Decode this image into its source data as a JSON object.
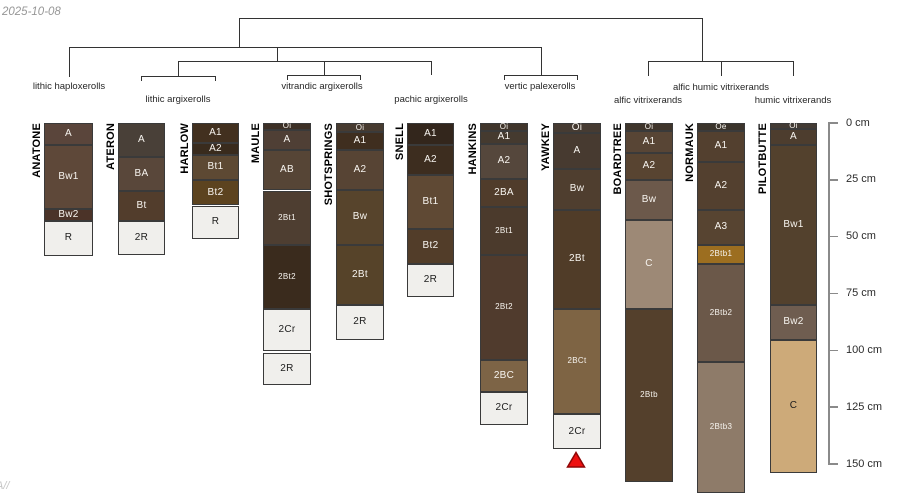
{
  "figure": {
    "date": "2025-10-08",
    "watermark": "A//",
    "background": "#ffffff"
  },
  "dendrogram": {
    "line_color": "#333333",
    "segments": [
      {
        "x1": 239,
        "y1": 18,
        "x2": 702,
        "y2": 18
      },
      {
        "x1": 239,
        "y1": 18,
        "x2": 239,
        "y2": 47
      },
      {
        "x1": 69,
        "y1": 47,
        "x2": 541,
        "y2": 47
      },
      {
        "x1": 69,
        "y1": 47,
        "x2": 69,
        "y2": 77
      },
      {
        "x1": 277,
        "y1": 47,
        "x2": 277,
        "y2": 61
      },
      {
        "x1": 178,
        "y1": 61,
        "x2": 431,
        "y2": 61
      },
      {
        "x1": 178,
        "y1": 61,
        "x2": 178,
        "y2": 76
      },
      {
        "x1": 141,
        "y1": 76,
        "x2": 215,
        "y2": 76
      },
      {
        "x1": 141,
        "y1": 76,
        "x2": 141,
        "y2": 81
      },
      {
        "x1": 215,
        "y1": 76,
        "x2": 215,
        "y2": 81
      },
      {
        "x1": 324,
        "y1": 61,
        "x2": 324,
        "y2": 75
      },
      {
        "x1": 287,
        "y1": 75,
        "x2": 360,
        "y2": 75
      },
      {
        "x1": 287,
        "y1": 75,
        "x2": 287,
        "y2": 80
      },
      {
        "x1": 360,
        "y1": 75,
        "x2": 360,
        "y2": 80
      },
      {
        "x1": 431,
        "y1": 61,
        "x2": 431,
        "y2": 75
      },
      {
        "x1": 541,
        "y1": 47,
        "x2": 541,
        "y2": 75
      },
      {
        "x1": 504,
        "y1": 75,
        "x2": 577,
        "y2": 75
      },
      {
        "x1": 504,
        "y1": 75,
        "x2": 504,
        "y2": 80
      },
      {
        "x1": 577,
        "y1": 75,
        "x2": 577,
        "y2": 80
      },
      {
        "x1": 702,
        "y1": 18,
        "x2": 702,
        "y2": 61
      },
      {
        "x1": 648,
        "y1": 61,
        "x2": 793,
        "y2": 61
      },
      {
        "x1": 648,
        "y1": 61,
        "x2": 648,
        "y2": 76
      },
      {
        "x1": 721,
        "y1": 61,
        "x2": 721,
        "y2": 76
      },
      {
        "x1": 793,
        "y1": 61,
        "x2": 793,
        "y2": 76
      }
    ],
    "taxa": [
      {
        "label": "lithic haploxerolls",
        "x": 69,
        "y": 87
      },
      {
        "label": "lithic argixerolls",
        "x": 178,
        "y": 100
      },
      {
        "label": "vitrandic argixerolls",
        "x": 322,
        "y": 87
      },
      {
        "label": "pachic argixerolls",
        "x": 431,
        "y": 100
      },
      {
        "label": "vertic palexerolls",
        "x": 540,
        "y": 87
      },
      {
        "label": "alfic humic vitrixerands",
        "x": 721,
        "y": 88
      },
      {
        "label": "alfic vitrixerands",
        "x": 648,
        "y": 101
      },
      {
        "label": "humic vitrixerands",
        "x": 793,
        "y": 101
      }
    ]
  },
  "depth_axis": {
    "unit": "cm",
    "line_color": "#8a8a8a",
    "label_color": "#2b2b2b",
    "ticks": [
      {
        "cm": 0,
        "label": "0 cm"
      },
      {
        "cm": 25,
        "label": "25 cm"
      },
      {
        "cm": 50,
        "label": "50 cm"
      },
      {
        "cm": 75,
        "label": "75 cm"
      },
      {
        "cm": 100,
        "label": "100 cm"
      },
      {
        "cm": 125,
        "label": "125 cm"
      },
      {
        "cm": 150,
        "label": "150 cm"
      }
    ]
  },
  "profiles": [
    {
      "name": "ANATONE",
      "x": 44,
      "width": 49,
      "horizons": [
        {
          "name": "A",
          "top_cm": 0,
          "bottom_cm": 9.5,
          "color": "#5a453b"
        },
        {
          "name": "Bw1",
          "top_cm": 9.5,
          "bottom_cm": 38,
          "color": "#5e4839"
        },
        {
          "name": "Bw2",
          "top_cm": 38,
          "bottom_cm": 43,
          "color": "#4b3328"
        },
        {
          "name": "R",
          "top_cm": 43,
          "bottom_cm": 58.5,
          "color": "#f0efec"
        }
      ]
    },
    {
      "name": "ATERON",
      "x": 118,
      "width": 47,
      "horizons": [
        {
          "name": "A",
          "top_cm": 0,
          "bottom_cm": 15,
          "color": "#494038"
        },
        {
          "name": "BA",
          "top_cm": 15,
          "bottom_cm": 30,
          "color": "#59473a"
        },
        {
          "name": "Bt",
          "top_cm": 30,
          "bottom_cm": 43,
          "color": "#523d2c"
        },
        {
          "name": "2R",
          "top_cm": 43,
          "bottom_cm": 58,
          "color": "#f0efec"
        }
      ]
    },
    {
      "name": "HARLOW",
      "x": 192,
      "width": 47,
      "horizons": [
        {
          "name": "A1",
          "top_cm": 0,
          "bottom_cm": 8.8,
          "color": "#42301f"
        },
        {
          "name": "A2",
          "top_cm": 8.8,
          "bottom_cm": 14,
          "color": "#392b1d"
        },
        {
          "name": "Bt1",
          "top_cm": 14,
          "bottom_cm": 25,
          "color": "#5d4933"
        },
        {
          "name": "Bt2",
          "top_cm": 25,
          "bottom_cm": 36.3,
          "color": "#5c431f"
        },
        {
          "name": "R",
          "top_cm": 36.3,
          "bottom_cm": 51,
          "color": "#f0efec"
        }
      ]
    },
    {
      "name": "MAULE",
      "x": 263,
      "width": 48,
      "horizons": [
        {
          "name": "Oi",
          "top_cm": 0,
          "bottom_cm": 3,
          "color": "#3d3026"
        },
        {
          "name": "A",
          "top_cm": 3,
          "bottom_cm": 12,
          "color": "#4f3f35"
        },
        {
          "name": "AB",
          "top_cm": 12,
          "bottom_cm": 29.7,
          "color": "#564536"
        },
        {
          "name": "2Bt1",
          "top_cm": 29.7,
          "bottom_cm": 53.5,
          "color": "#4e3e31"
        },
        {
          "name": "2Bt2",
          "top_cm": 53.5,
          "bottom_cm": 81.7,
          "color": "#3a2b1d"
        },
        {
          "name": "2Cr",
          "top_cm": 81.7,
          "bottom_cm": 100.2,
          "color": "#f0efec"
        },
        {
          "name": "2R",
          "top_cm": 101.2,
          "bottom_cm": 115.3,
          "color": "#f0efec"
        }
      ]
    },
    {
      "name": "SHOTSPRINGS",
      "x": 336,
      "width": 48,
      "horizons": [
        {
          "name": "Oi",
          "top_cm": 0,
          "bottom_cm": 4,
          "color": "#473b30"
        },
        {
          "name": "A1",
          "top_cm": 4,
          "bottom_cm": 11.7,
          "color": "#3f2e1f"
        },
        {
          "name": "A2",
          "top_cm": 11.7,
          "bottom_cm": 29.3,
          "color": "#574434"
        },
        {
          "name": "Bw",
          "top_cm": 29.3,
          "bottom_cm": 53.5,
          "color": "#57442c"
        },
        {
          "name": "2Bt",
          "top_cm": 53.5,
          "bottom_cm": 80,
          "color": "#564329"
        },
        {
          "name": "2R",
          "top_cm": 80,
          "bottom_cm": 95.4,
          "color": "#f0efec"
        }
      ]
    },
    {
      "name": "SNELL",
      "x": 407,
      "width": 47,
      "horizons": [
        {
          "name": "A1",
          "top_cm": 0,
          "bottom_cm": 9.5,
          "color": "#33261c"
        },
        {
          "name": "A2",
          "top_cm": 9.5,
          "bottom_cm": 22.7,
          "color": "#3d2d1f"
        },
        {
          "name": "Bt1",
          "top_cm": 22.7,
          "bottom_cm": 46.5,
          "color": "#5f4934"
        },
        {
          "name": "Bt2",
          "top_cm": 46.5,
          "bottom_cm": 61.9,
          "color": "#523d29"
        },
        {
          "name": "2R",
          "top_cm": 61.9,
          "bottom_cm": 76.4,
          "color": "#f0efec"
        }
      ]
    },
    {
      "name": "HANKINS",
      "x": 480,
      "width": 48,
      "horizons": [
        {
          "name": "Oi",
          "top_cm": 0,
          "bottom_cm": 3.3,
          "color": "#40352b"
        },
        {
          "name": "A1",
          "top_cm": 3.3,
          "bottom_cm": 9,
          "color": "#453a2f"
        },
        {
          "name": "A2",
          "top_cm": 9,
          "bottom_cm": 24.4,
          "color": "#55473c"
        },
        {
          "name": "2BA",
          "top_cm": 24.4,
          "bottom_cm": 36.8,
          "color": "#503c2b"
        },
        {
          "name": "2Bt1",
          "top_cm": 36.8,
          "bottom_cm": 57.9,
          "color": "#4b3a2c"
        },
        {
          "name": "2Bt2",
          "top_cm": 57.9,
          "bottom_cm": 104.2,
          "color": "#503b2d"
        },
        {
          "name": "2BC",
          "top_cm": 104.2,
          "bottom_cm": 118.3,
          "color": "#7d6446"
        },
        {
          "name": "2Cr",
          "top_cm": 118.3,
          "bottom_cm": 132.8,
          "color": "#f0efec"
        }
      ]
    },
    {
      "name": "YAWKEY",
      "x": 553,
      "width": 48,
      "horizons": [
        {
          "name": "Oi",
          "top_cm": 0,
          "bottom_cm": 4.4,
          "color": "#463b32"
        },
        {
          "name": "A",
          "top_cm": 4.4,
          "bottom_cm": 20,
          "color": "#473a30"
        },
        {
          "name": "Bw",
          "top_cm": 20,
          "bottom_cm": 38.1,
          "color": "#4f3e2f"
        },
        {
          "name": "2Bt",
          "top_cm": 38.1,
          "bottom_cm": 81.7,
          "color": "#503c28"
        },
        {
          "name": "2BCt",
          "top_cm": 81.7,
          "bottom_cm": 128,
          "color": "#7e6444"
        },
        {
          "name": "2Cr",
          "top_cm": 128,
          "bottom_cm": 143.4,
          "color": "#f0efec"
        }
      ]
    },
    {
      "name": "BOARDTREE",
      "x": 625,
      "width": 48,
      "horizons": [
        {
          "name": "Oi",
          "top_cm": 0,
          "bottom_cm": 3.5,
          "color": "#3f352b"
        },
        {
          "name": "A1",
          "top_cm": 3.5,
          "bottom_cm": 13,
          "color": "#584535"
        },
        {
          "name": "A2",
          "top_cm": 13,
          "bottom_cm": 24.9,
          "color": "#584431"
        },
        {
          "name": "Bw",
          "top_cm": 24.9,
          "bottom_cm": 42.5,
          "color": "#6c594b"
        },
        {
          "name": "C",
          "top_cm": 42.5,
          "bottom_cm": 81.7,
          "color": "#9d8976"
        },
        {
          "name": "2Btb",
          "top_cm": 81.7,
          "bottom_cm": 157.9,
          "color": "#54402c"
        }
      ]
    },
    {
      "name": "NORMAUK",
      "x": 697,
      "width": 48,
      "horizons": [
        {
          "name": "Oe",
          "top_cm": 0,
          "bottom_cm": 3.7,
          "color": "#3b342c"
        },
        {
          "name": "A1",
          "top_cm": 3.7,
          "bottom_cm": 17,
          "color": "#53402f"
        },
        {
          "name": "A2",
          "top_cm": 17,
          "bottom_cm": 38.1,
          "color": "#53402f"
        },
        {
          "name": "A3",
          "top_cm": 38.1,
          "bottom_cm": 53.5,
          "color": "#574431"
        },
        {
          "name": "2Btb1",
          "top_cm": 53.5,
          "bottom_cm": 61.9,
          "color": "#9c6e20"
        },
        {
          "name": "2Btb2",
          "top_cm": 61.9,
          "bottom_cm": 105.1,
          "color": "#6b5849"
        },
        {
          "name": "2Btb3",
          "top_cm": 105.1,
          "bottom_cm": 162.8,
          "color": "#8e7b69"
        }
      ]
    },
    {
      "name": "PILOTBUTTE",
      "x": 770,
      "width": 47,
      "horizons": [
        {
          "name": "Oi",
          "top_cm": 0,
          "bottom_cm": 2.6,
          "color": "#433b34"
        },
        {
          "name": "A",
          "top_cm": 2.6,
          "bottom_cm": 9.5,
          "color": "#4d3d2e"
        },
        {
          "name": "Bw1",
          "top_cm": 9.5,
          "bottom_cm": 80,
          "color": "#53412d"
        },
        {
          "name": "Bw2",
          "top_cm": 80,
          "bottom_cm": 95.4,
          "color": "#6f5d50"
        },
        {
          "name": "C",
          "top_cm": 95.4,
          "bottom_cm": 153.9,
          "color": "#cdaa79"
        }
      ]
    }
  ],
  "marker": {
    "shape": "triangle-up",
    "series": "YAWKEY",
    "x": 576,
    "y": 451,
    "fill": "#ee1010",
    "stroke": "#8f0606"
  }
}
